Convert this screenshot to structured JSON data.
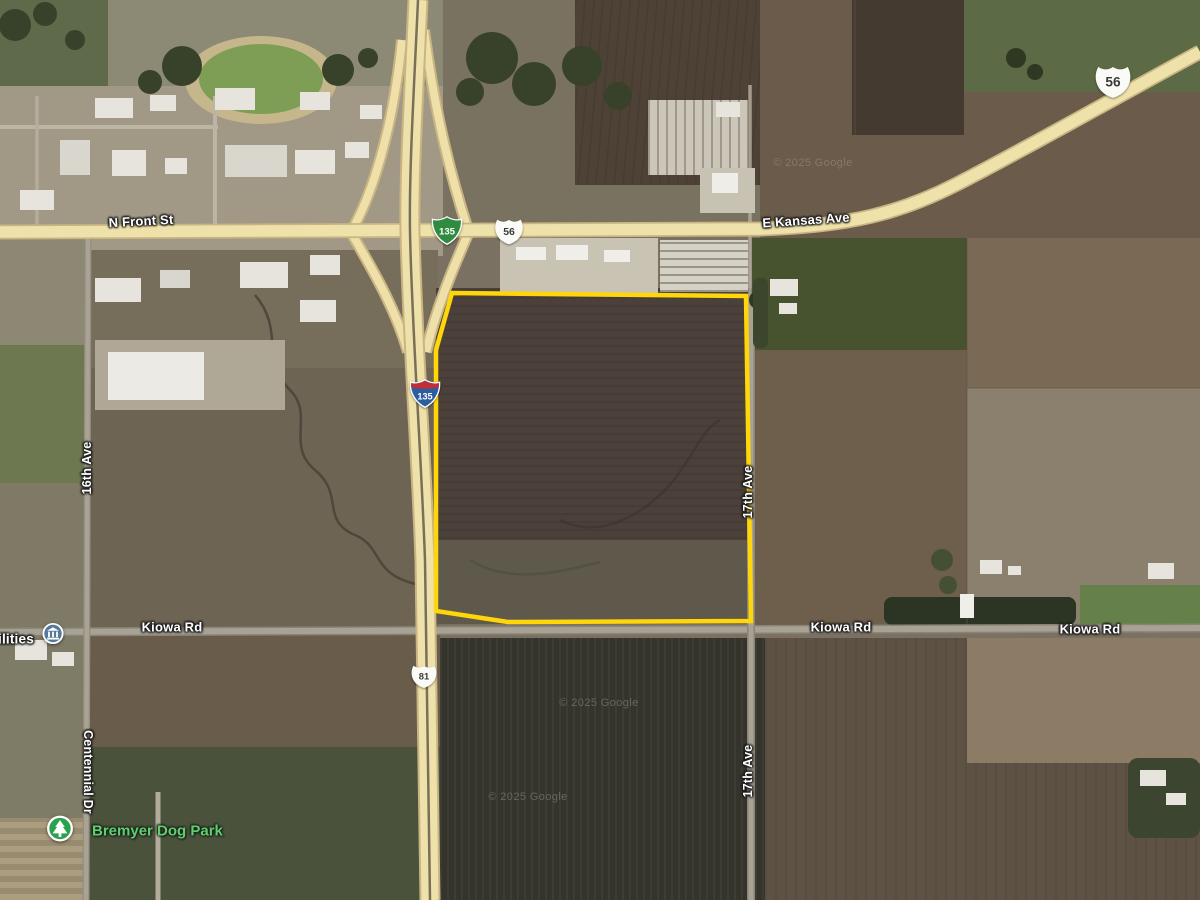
{
  "map": {
    "attribution": "© 2025 Google",
    "roads": {
      "n_front_st": "N Front St",
      "e_kansas_ave": "E Kansas Ave",
      "kiowa_rd": "Kiowa Rd",
      "sixteenth_ave": "16th Ave",
      "seventeenth_ave": "17th Ave",
      "centennial_dr": "Centennial Dr"
    },
    "shields": {
      "interstate_135": {
        "number": "135",
        "color": "#2c5d9e"
      },
      "business_loop_135": {
        "number": "135",
        "color": "#2e8b3f"
      },
      "us_56": {
        "number": "56",
        "color": "#fafaf6"
      },
      "us_81": {
        "number": "81",
        "color": "#fafaf6"
      }
    },
    "pois": {
      "dog_park": {
        "label": "Bremyer Dog Park",
        "color": "#64cd70"
      },
      "utilities_partial": {
        "label": "ilities"
      }
    },
    "parcel": {
      "outline_color": "#FFD60A"
    }
  }
}
